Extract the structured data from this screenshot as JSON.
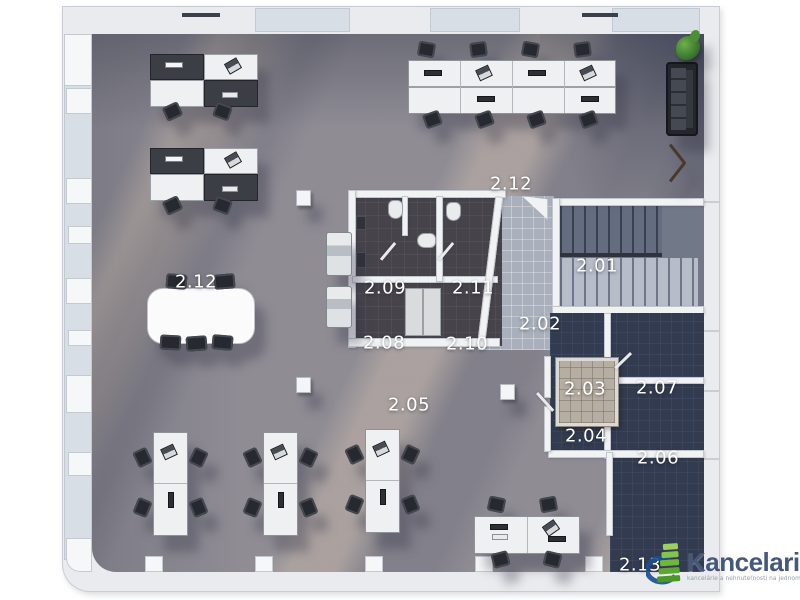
{
  "plan": {
    "type": "office-floor-plan",
    "rooms": [
      {
        "id": "corridor-top",
        "label": "2.12"
      },
      {
        "id": "staircase",
        "label": "2.01"
      },
      {
        "id": "wc-left",
        "label": "2.09"
      },
      {
        "id": "wc-right",
        "label": "2.11"
      },
      {
        "id": "landing",
        "label": "2.02"
      },
      {
        "id": "wc-lower-left",
        "label": "2.08"
      },
      {
        "id": "wc-lower-right",
        "label": "2.10"
      },
      {
        "id": "meeting-area",
        "label": "2.12"
      },
      {
        "id": "elevator",
        "label": "2.03"
      },
      {
        "id": "room-right",
        "label": "2.07"
      },
      {
        "id": "room-small",
        "label": "2.04"
      },
      {
        "id": "room-lower",
        "label": "2.06"
      },
      {
        "id": "open-office",
        "label": "2.05"
      },
      {
        "id": "corner-office",
        "label": "2.13"
      }
    ],
    "palette": {
      "floor": "#8f8c94",
      "dark_rooms": "#333b50",
      "walls": "#f1f2f4",
      "corridor_tiles": "#a9b0bb",
      "bathroom_floor": "#46434b",
      "label_text": "#ffffff"
    }
  },
  "watermark": {
    "brand": "Kancelarie",
    "tld": ".sk",
    "tagline": "kancelárie a nehnuteľnosti na jednom mieste",
    "logo_green": "#6fb43c",
    "logo_blue": "#1d4f8f"
  }
}
